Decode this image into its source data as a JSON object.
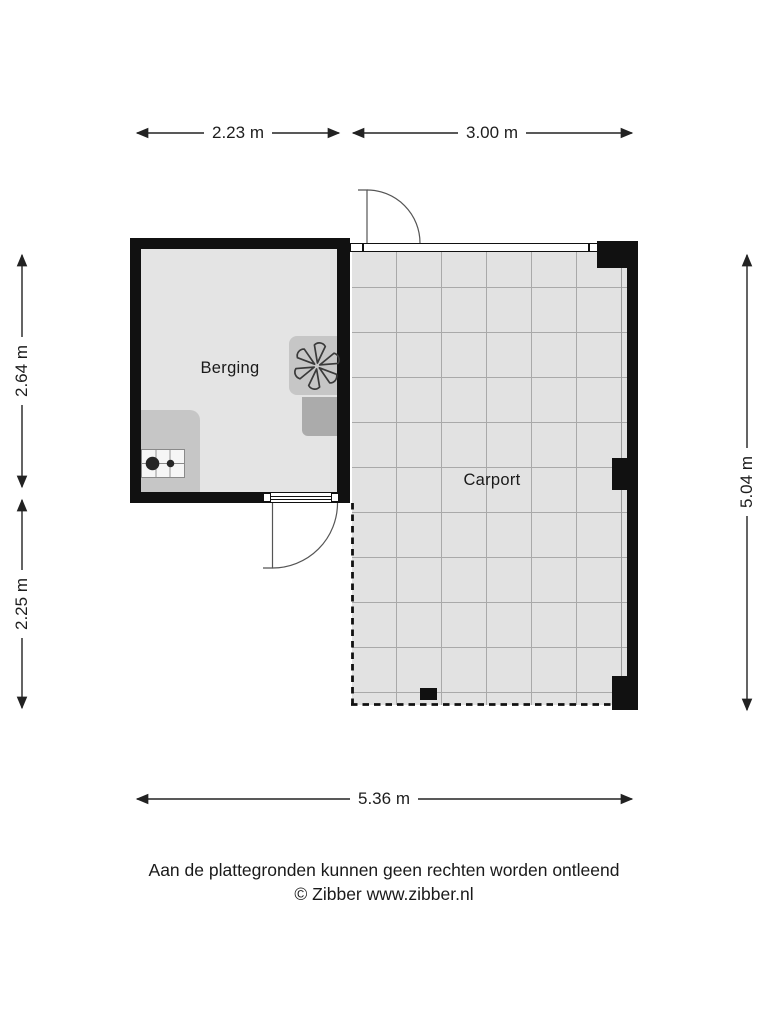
{
  "plan": {
    "rooms": [
      {
        "label": "Berging"
      },
      {
        "label": "Carport"
      }
    ]
  },
  "dimensions": {
    "top_left": "2.23 m",
    "top_right": "3.00 m",
    "left_upper": "2.64 m",
    "left_lower": "2.25 m",
    "right_side": "5.04 m",
    "bottom": "5.36 m"
  },
  "icons": {
    "fan": "fan-icon",
    "stove": "stove-icon"
  },
  "footer": {
    "disclaimer": "Aan de plattegronden kunnen geen rechten worden ontleend",
    "copyright": "© Zibber www.zibber.nl"
  },
  "colors": {
    "wall": "#111111",
    "floor_berging": "#e4e4e4",
    "floor_carport": "#e2e2e2",
    "grid_line": "#a9a9a9",
    "fixture": "#c6c6c6",
    "fixture_dark": "#ababab",
    "text": "#1a1a1a"
  }
}
